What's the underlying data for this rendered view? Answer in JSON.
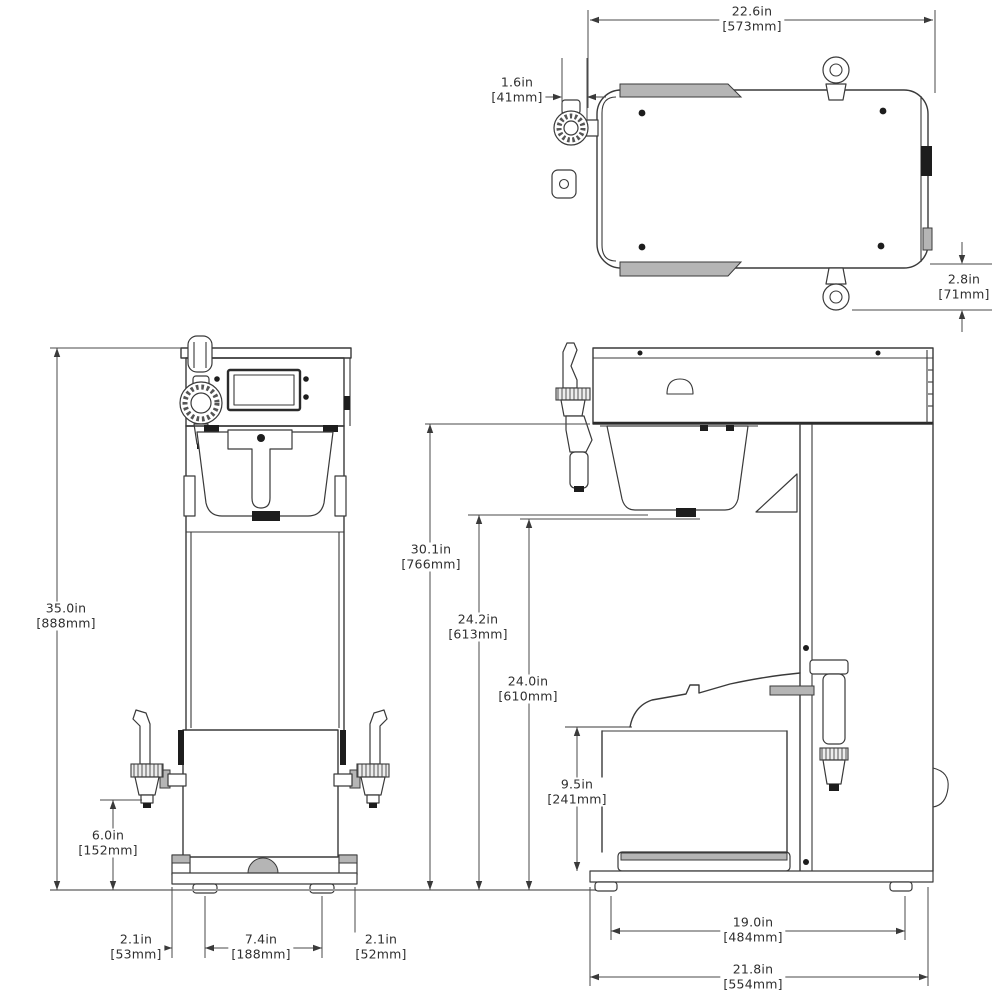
{
  "drawing": {
    "background": "#ffffff",
    "line_color": "#3a3a3a",
    "gray_fill": "#b5b5b5"
  },
  "dims": {
    "top_width": {
      "in": "22.6in",
      "mm": "[573mm]"
    },
    "top_offset": {
      "in": "1.6in",
      "mm": "[41mm]"
    },
    "side_protrusion": {
      "in": "2.8in",
      "mm": "[71mm]"
    },
    "overall_height": {
      "in": "35.0in",
      "mm": "[888mm]"
    },
    "faucet_height": {
      "in": "6.0in",
      "mm": "[152mm]"
    },
    "foot_offset_left": {
      "in": "2.1in",
      "mm": "[53mm]"
    },
    "foot_span": {
      "in": "7.4in",
      "mm": "[188mm]"
    },
    "foot_offset_right": {
      "in": "2.1in",
      "mm": "[52mm]"
    },
    "trunk_height": {
      "in": "30.1in",
      "mm": "[766mm]"
    },
    "clearance_a": {
      "in": "24.2in",
      "mm": "[613mm]"
    },
    "clearance_b": {
      "in": "24.0in",
      "mm": "[610mm]"
    },
    "server_space": {
      "in": "9.5in",
      "mm": "[241mm]"
    },
    "depth_feet": {
      "in": "19.0in",
      "mm": "[484mm]"
    },
    "depth_overall": {
      "in": "21.8in",
      "mm": "[554mm]"
    }
  }
}
